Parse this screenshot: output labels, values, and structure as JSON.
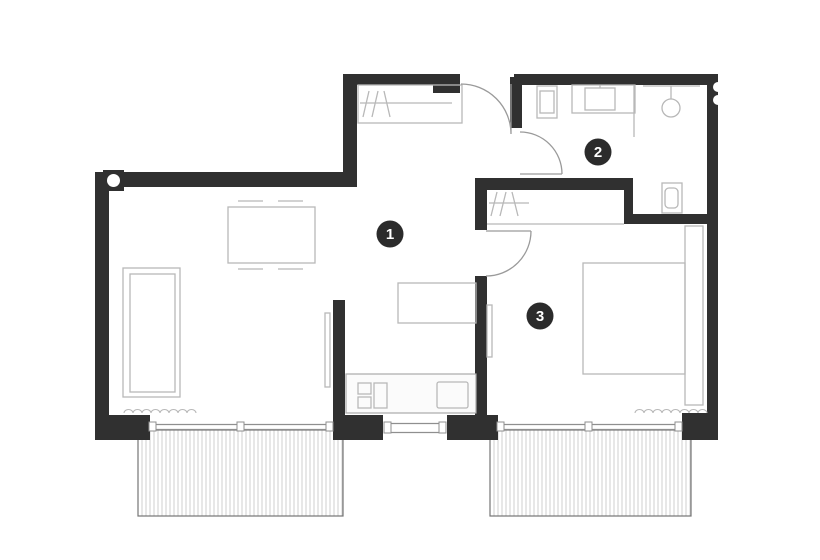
{
  "plan": {
    "type": "apartment-floor-plan",
    "rooms": [
      {
        "number": "1",
        "name": "living-dining-kitchen"
      },
      {
        "number": "2",
        "name": "bathroom"
      },
      {
        "number": "3",
        "name": "bedroom"
      }
    ],
    "features": {
      "balconies": [
        "balcony-left",
        "balcony-right"
      ],
      "doors": [
        "entry-door",
        "bathroom-door",
        "bedroom-door"
      ],
      "windows": [
        "living-room-window",
        "kitchen-window",
        "bedroom-window"
      ],
      "fixtures": [
        "entry-wardrobe",
        "hall-wardrobe",
        "dining-table",
        "sofa",
        "kitchen-counter",
        "kitchen-island",
        "cooktop",
        "kitchen-sink",
        "washing-machine",
        "vanity-sink",
        "shower",
        "toilet",
        "double-bed",
        "headboard-panel",
        "column",
        "curtains"
      ]
    },
    "colors": {
      "wall": "#303030",
      "furniture_line": "#b8b8b8",
      "door_line": "#9a9a9a",
      "window_line": "#8f8f8f",
      "balcony_border": "#757575",
      "hatch_line": "#cfcfcf",
      "label_bg": "#2b2b2b",
      "label_text": "#ffffff",
      "background": "#ffffff"
    }
  }
}
